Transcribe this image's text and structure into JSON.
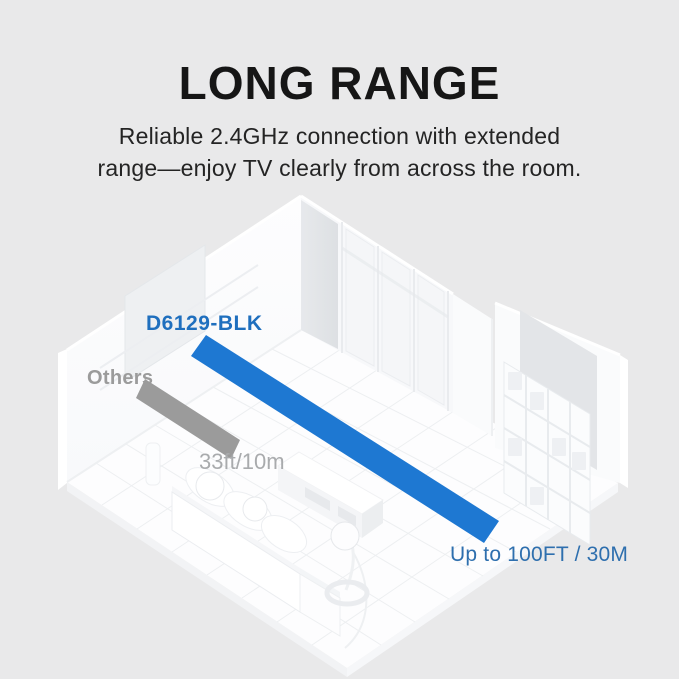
{
  "header": {
    "title": "LONG RANGE",
    "subtitle_line1": "Reliable 2.4GHz connection with extended",
    "subtitle_line2": "range—enjoy TV clearly from across the room."
  },
  "diagram": {
    "product_label": "D6129-BLK",
    "others_label": "Others",
    "others_range": "33ft/10m",
    "product_range": "Up to 100FT / 30M"
  },
  "colors": {
    "accent-blue": "#1e78d2",
    "label-blue": "#1f6fbe",
    "range-blue": "#2e6fae",
    "others-gray": "#9b9b9b",
    "range-gray": "#a9abad",
    "bg": "#e9e9ea"
  }
}
